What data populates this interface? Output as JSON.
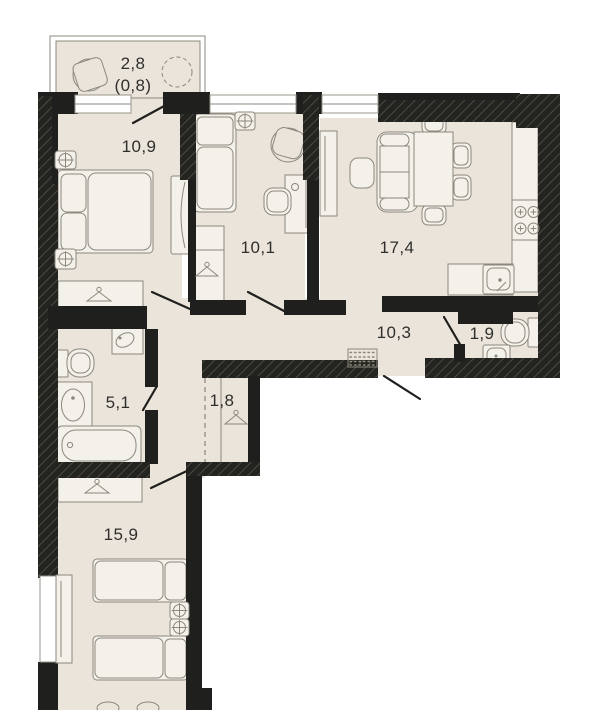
{
  "plan": {
    "type": "apartment-floor-plan",
    "rooms": [
      {
        "id": "balcony",
        "area": "2,8",
        "area_reduced": "(0,8)"
      },
      {
        "id": "bedroom-1",
        "area": "10,9"
      },
      {
        "id": "room-2",
        "area": "10,1"
      },
      {
        "id": "kitchen-living",
        "area": "17,4"
      },
      {
        "id": "hallway",
        "area": "10,3"
      },
      {
        "id": "wc",
        "area": "1,9"
      },
      {
        "id": "bathroom",
        "area": "5,1"
      },
      {
        "id": "wardrobe-niche",
        "area": "1,8"
      },
      {
        "id": "bedroom-2",
        "area": "15,9"
      }
    ],
    "colors": {
      "wall": "#1f1f1d",
      "floor": "#eae4da",
      "furniture_fill": "#f4f1ea",
      "outline": "#8b887e",
      "label": "#2f2f2d",
      "background": "#ffffff"
    }
  }
}
